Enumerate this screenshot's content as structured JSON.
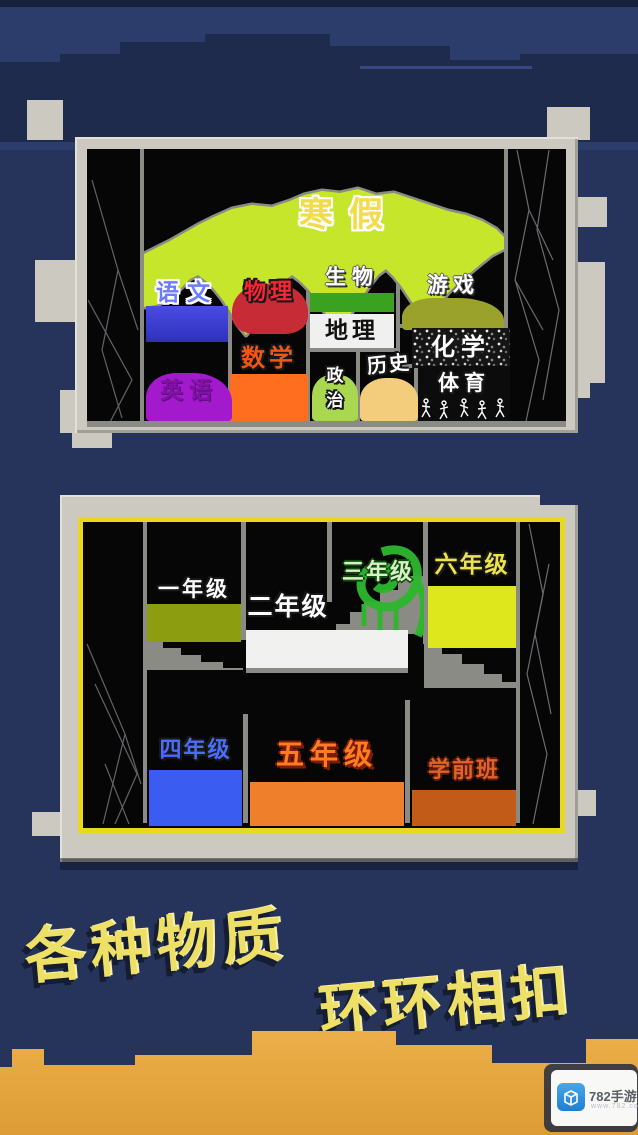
{
  "p1": {
    "title": {
      "label": "寒假",
      "text_color": "#f2dc4a",
      "blob_color": "#c6e62c"
    },
    "subjects": {
      "yuwen": {
        "label": "语文",
        "color": "#3d3fd8"
      },
      "wuli": {
        "label": "物理",
        "color": "#c62b36"
      },
      "shengwu": {
        "label": "生物",
        "color": "#3aa121"
      },
      "dili": {
        "label": "地理",
        "color": "#f0f0ee"
      },
      "youxi": {
        "label": "游戏",
        "color": "#9aa22b"
      },
      "huaxue": {
        "label": "化学",
        "color": "#2a2a2a"
      },
      "shuxue": {
        "label": "数学",
        "color": "#ff6e1f"
      },
      "yingyu": {
        "label": "英语",
        "color": "#a21acc"
      },
      "zhengzhi": {
        "label": "政治",
        "color": "#a9d850"
      },
      "lishi": {
        "label": "历史",
        "color": "#f3cd7b"
      },
      "tiyu": {
        "label": "体育",
        "color": "#0a0a0a"
      }
    }
  },
  "p2": {
    "grades": {
      "g1": {
        "label": "一年级",
        "color": "#8c9d10"
      },
      "g2": {
        "label": "二年级",
        "color": "#f1f1ef"
      },
      "g3": {
        "label": "三年级",
        "color": "#2db82d"
      },
      "g6": {
        "label": "六年级",
        "color": "#dde71b"
      },
      "g4": {
        "label": "四年级",
        "color": "#3a5cf0"
      },
      "g5": {
        "label": "五年级",
        "color": "#ef7f2b"
      },
      "pre": {
        "label": "学前班",
        "color": "#c25b17"
      }
    }
  },
  "caption": {
    "line1": "各种物质",
    "line2": "环环相扣",
    "color": "#eee066"
  },
  "watermark": {
    "site": "782手游网",
    "url": "www.782.com"
  }
}
